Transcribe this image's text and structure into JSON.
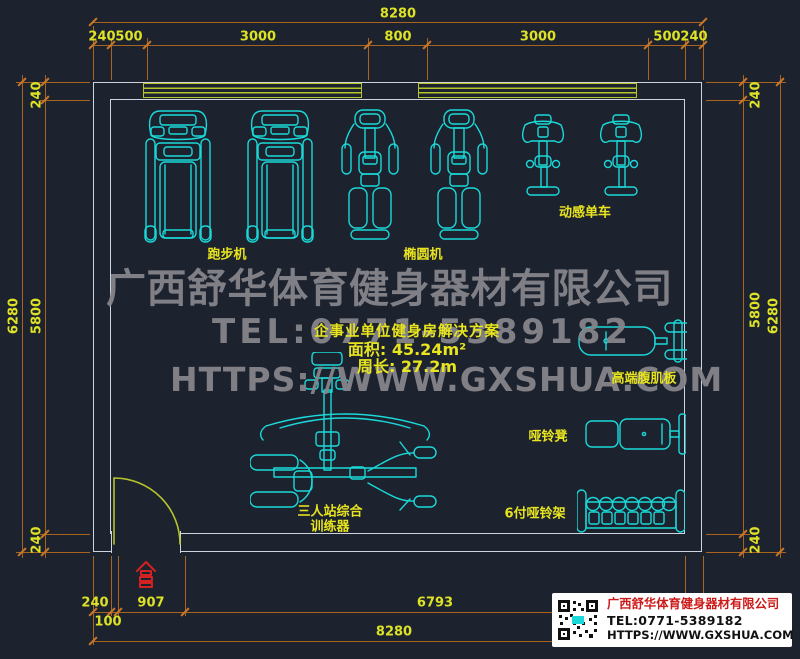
{
  "watermark": {
    "company": "广西舒华体育健身器材有限公司",
    "tel": "TEL:0771-5389182",
    "url": "HTTPS://WWW.GXSHUA.COM"
  },
  "plan": {
    "title": "企事业单位健身房解决方案",
    "area": "面积: 45.24m²",
    "perimeter": "周长: 27.2m"
  },
  "labels": {
    "treadmill": "跑步机",
    "elliptical": "椭圆机",
    "spin_bike": "动感单车",
    "abs_board": "高端腹肌板",
    "dumbbell_bench": "哑铃凳",
    "dumbbell_rack": "6付哑铃架",
    "multi_station_1": "三人站综合",
    "multi_station_2": "训练器"
  },
  "dimensions": {
    "top_total": "8280",
    "top_segments": [
      "240",
      "500",
      "3000",
      "800",
      "3000",
      "500",
      "240"
    ],
    "left_total": "6280",
    "left_segments": [
      "240",
      "5800",
      "240"
    ],
    "right_total": "6280",
    "right_segments": [
      "240",
      "5800",
      "240"
    ],
    "bottom_segments": [
      "240",
      "100",
      "907",
      "6793"
    ],
    "bottom_total": "8280"
  },
  "info_card": {
    "company": "广西舒华体育健身器材有限公司",
    "tel": "TEL:0771-5389182",
    "url": "HTTPS://WWW.GXSHUA.COM",
    "qr_icon": "qr-code"
  },
  "colors": {
    "background": "#1c222e",
    "equipment": "#1bd9d9",
    "dimension_line": "#a96520",
    "dimension_text": "#dde226",
    "label_text": "#e8e41f",
    "wall": "#d0d4dc",
    "window_door": "#b5c42a",
    "watermark": "#85858a",
    "accent_red": "#d42222"
  }
}
